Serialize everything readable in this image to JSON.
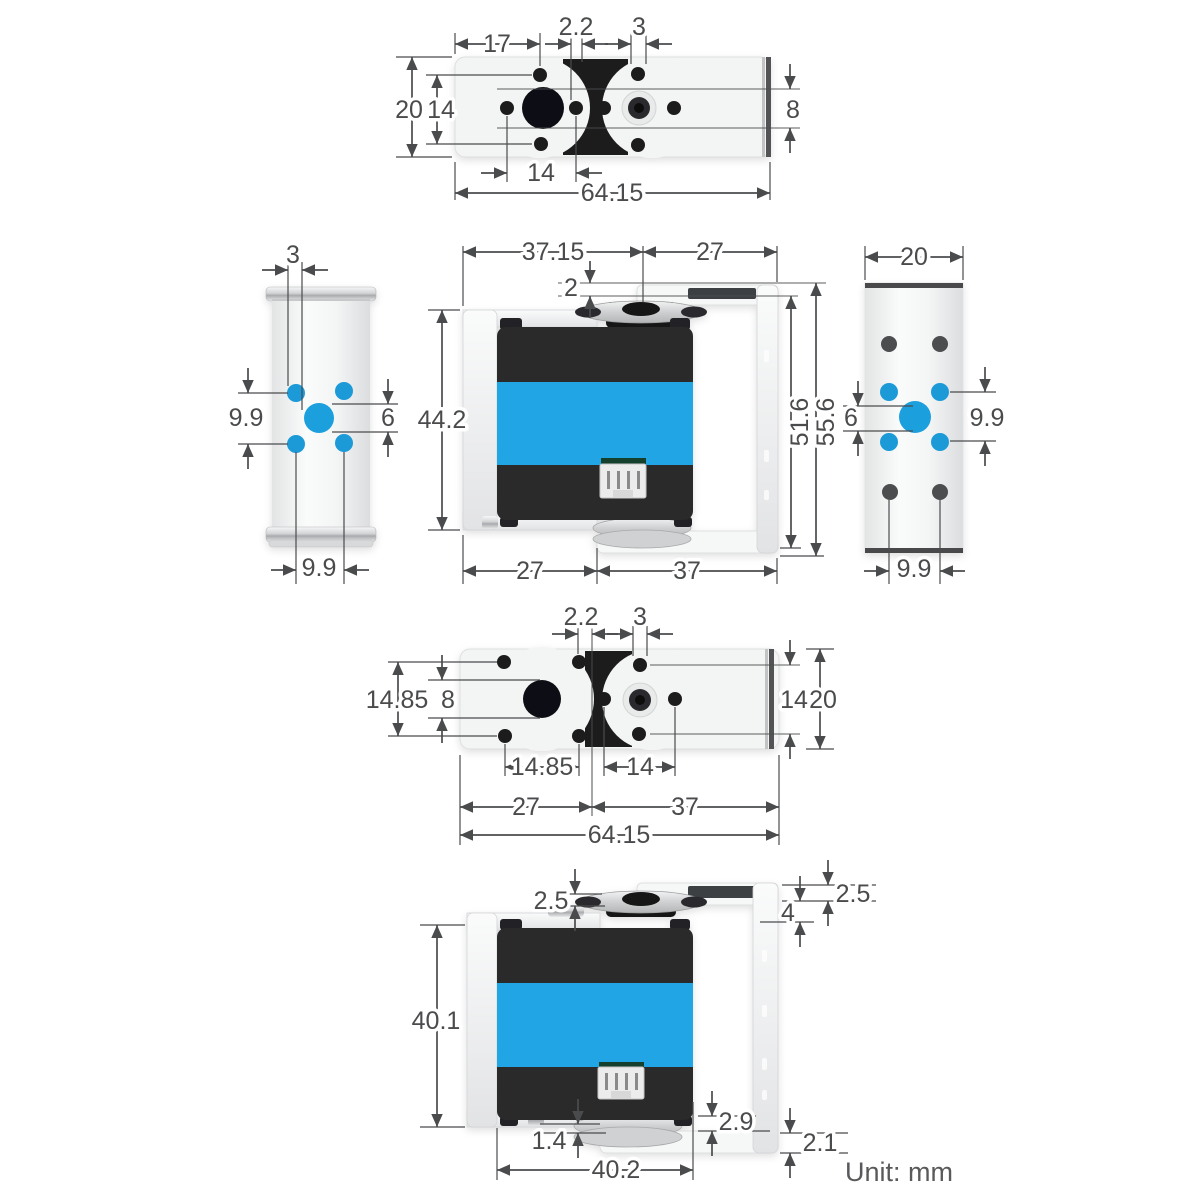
{
  "unit": {
    "label": "Unit: mm"
  },
  "colors": {
    "accent_blue": "#24a5e4",
    "hole_blue": "#1d9ad8",
    "servo_body_dark": "#2a2a2c",
    "dimension_gray": "#4a4b4d",
    "metal_light": "#f3f4f4"
  },
  "views": {
    "top_view": {
      "title": "servo top view",
      "dims": {
        "d17": "17",
        "d2_2": "2.2",
        "d3": "3",
        "d20": "20",
        "d14": "14",
        "d8": "8",
        "d14b": "14",
        "d64_15": "64.15"
      }
    },
    "left_side_view": {
      "title": "bracket side view left",
      "dims": {
        "d3": "3",
        "d9_9l": "9.9",
        "d6": "6",
        "d9_9b": "9.9"
      }
    },
    "front_view": {
      "title": "servo front assembly view",
      "dims": {
        "d37_15": "37.15",
        "d27t": "27",
        "d2": "2",
        "d44_2": "44.2",
        "d51_6": "51.6",
        "d55_6": "55.6",
        "d27b": "27",
        "d37b": "37"
      }
    },
    "right_side_view": {
      "title": "bracket side view right",
      "dims": {
        "d20": "20",
        "d6": "6",
        "d9_9r": "9.9",
        "d9_9b": "9.9"
      }
    },
    "bottom_top_view": {
      "title": "servo top view alternate",
      "dims": {
        "d2_2": "2.2",
        "d3": "3",
        "d14_85l": "14.85",
        "d8": "8",
        "d14r": "14",
        "d20": "20",
        "d14_85m": "14.85",
        "d14m": "14",
        "d27": "27",
        "d37": "37",
        "d64_15": "64.15"
      }
    },
    "bottom_front_view": {
      "title": "servo front assembly bottom view",
      "dims": {
        "d2_5l": "2.5",
        "d2_5r": "2.5",
        "d4": "4",
        "d40_1": "40.1",
        "d2_9": "2.9",
        "d1_4": "1.4",
        "d2_1": "2.1",
        "d40_2": "40.2"
      }
    }
  }
}
